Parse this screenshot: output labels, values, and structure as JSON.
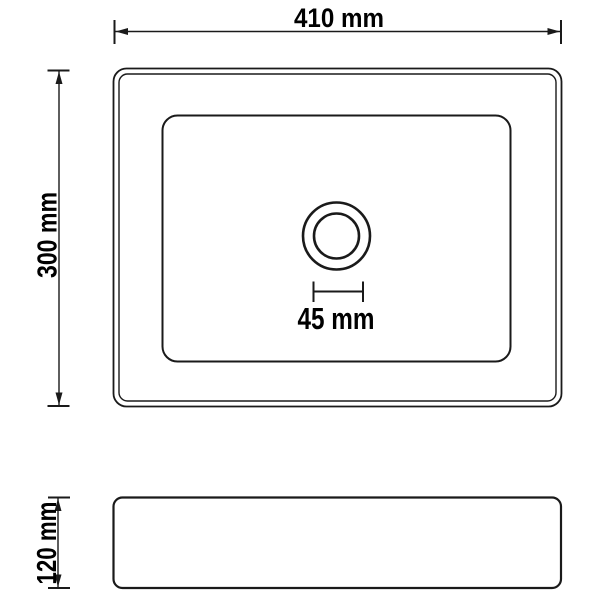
{
  "colors": {
    "background": "#ffffff",
    "line": "#1a1a1a",
    "text": "#000000"
  },
  "dimensions": {
    "width": {
      "label": "410 mm",
      "value": 410,
      "unit": "mm"
    },
    "height": {
      "label": "300 mm",
      "value": 300,
      "unit": "mm"
    },
    "drain": {
      "label": "45 mm",
      "value": 45,
      "unit": "mm"
    },
    "depth": {
      "label": "120 mm",
      "value": 120,
      "unit": "mm"
    }
  }
}
